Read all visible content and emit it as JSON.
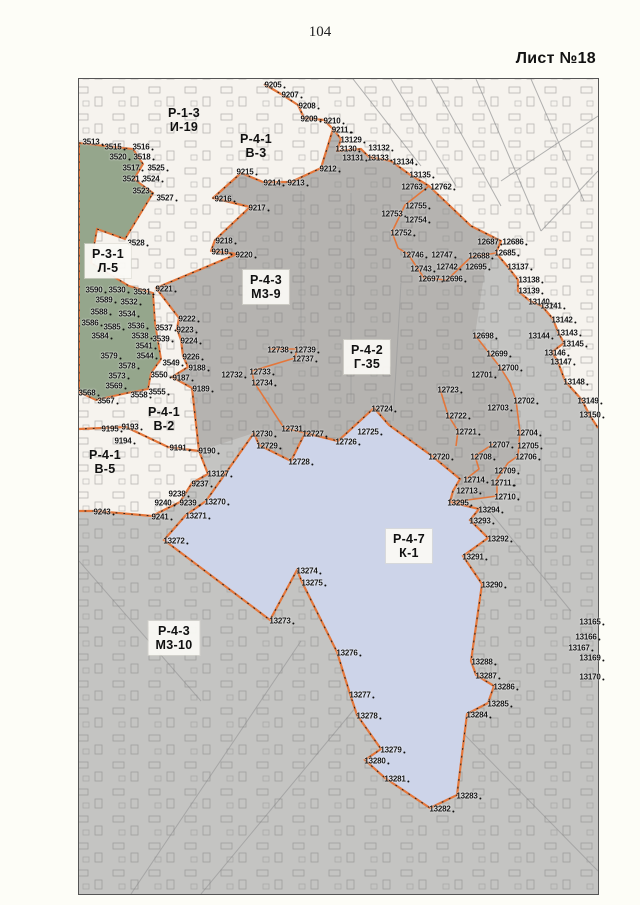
{
  "page": {
    "number": "104",
    "sheet_label": "Лист №18"
  },
  "map": {
    "colors": {
      "page_bg": "#fdfdf7",
      "map_white": "#f6f3ee",
      "gray_zone": "#c4c4c2",
      "dark_gray_zone": "#b5b3b0",
      "green_zone": "#95a68c",
      "lake": "#cdd4e9",
      "boundary_orange": "#e4763a"
    },
    "zones": [
      {
        "code": "Р-1-3",
        "sub": "И-19",
        "x": 183,
        "y": 119,
        "boxed": false
      },
      {
        "code": "Р-4-1",
        "sub": "В-3",
        "x": 255,
        "y": 145,
        "boxed": false
      },
      {
        "code": "Р-3-1",
        "sub": "Л-5",
        "x": 107,
        "y": 260,
        "boxed": true
      },
      {
        "code": "Р-4-3",
        "sub": "М3-9",
        "x": 265,
        "y": 286,
        "boxed": true
      },
      {
        "code": "Р-4-2",
        "sub": "Г-35",
        "x": 366,
        "y": 356,
        "boxed": true
      },
      {
        "code": "Р-4-1",
        "sub": "В-2",
        "x": 163,
        "y": 418,
        "boxed": false
      },
      {
        "code": "Р-4-1",
        "sub": "В-5",
        "x": 104,
        "y": 461,
        "boxed": false
      },
      {
        "code": "Р-4-7",
        "sub": "К-1",
        "x": 408,
        "y": 545,
        "boxed": true
      },
      {
        "code": "Р-4-3",
        "sub": "М3-10",
        "x": 173,
        "y": 637,
        "boxed": true
      }
    ],
    "points": [
      {
        "n": "3513",
        "x": 90,
        "y": 141
      },
      {
        "n": "3515",
        "x": 112,
        "y": 146
      },
      {
        "n": "3516",
        "x": 140,
        "y": 146
      },
      {
        "n": "3520",
        "x": 117,
        "y": 156
      },
      {
        "n": "3518",
        "x": 141,
        "y": 156
      },
      {
        "n": "3517",
        "x": 130,
        "y": 167
      },
      {
        "n": "3525",
        "x": 155,
        "y": 167
      },
      {
        "n": "3521",
        "x": 130,
        "y": 178
      },
      {
        "n": "3524",
        "x": 150,
        "y": 178
      },
      {
        "n": "3523",
        "x": 140,
        "y": 190
      },
      {
        "n": "3527",
        "x": 164,
        "y": 197
      },
      {
        "n": "3528",
        "x": 135,
        "y": 242
      },
      {
        "n": "9205",
        "x": 272,
        "y": 84
      },
      {
        "n": "9207",
        "x": 289,
        "y": 94
      },
      {
        "n": "9208",
        "x": 306,
        "y": 105
      },
      {
        "n": "9209",
        "x": 308,
        "y": 118
      },
      {
        "n": "9210",
        "x": 331,
        "y": 120
      },
      {
        "n": "9211",
        "x": 339,
        "y": 129
      },
      {
        "n": "13129",
        "x": 350,
        "y": 139
      },
      {
        "n": "13130",
        "x": 345,
        "y": 148
      },
      {
        "n": "13131",
        "x": 352,
        "y": 157
      },
      {
        "n": "13132",
        "x": 378,
        "y": 147
      },
      {
        "n": "13133",
        "x": 377,
        "y": 157
      },
      {
        "n": "13134",
        "x": 402,
        "y": 161
      },
      {
        "n": "13135",
        "x": 419,
        "y": 174
      },
      {
        "n": "9212",
        "x": 327,
        "y": 168
      },
      {
        "n": "9215",
        "x": 244,
        "y": 171
      },
      {
        "n": "9214",
        "x": 271,
        "y": 182
      },
      {
        "n": "9213",
        "x": 295,
        "y": 182
      },
      {
        "n": "9216",
        "x": 222,
        "y": 198
      },
      {
        "n": "9217",
        "x": 256,
        "y": 207
      },
      {
        "n": "9218",
        "x": 223,
        "y": 240
      },
      {
        "n": "9219",
        "x": 219,
        "y": 251
      },
      {
        "n": "9220",
        "x": 243,
        "y": 254
      },
      {
        "n": "12763",
        "x": 411,
        "y": 186
      },
      {
        "n": "12762",
        "x": 440,
        "y": 186
      },
      {
        "n": "12755",
        "x": 415,
        "y": 205
      },
      {
        "n": "12753",
        "x": 391,
        "y": 213
      },
      {
        "n": "12754",
        "x": 415,
        "y": 219
      },
      {
        "n": "12752",
        "x": 400,
        "y": 232
      },
      {
        "n": "12687",
        "x": 487,
        "y": 241
      },
      {
        "n": "12686",
        "x": 512,
        "y": 241
      },
      {
        "n": "12746",
        "x": 412,
        "y": 254
      },
      {
        "n": "12747",
        "x": 441,
        "y": 254
      },
      {
        "n": "12688",
        "x": 478,
        "y": 255
      },
      {
        "n": "12685",
        "x": 504,
        "y": 252
      },
      {
        "n": "12743",
        "x": 420,
        "y": 268
      },
      {
        "n": "12742",
        "x": 446,
        "y": 266
      },
      {
        "n": "12695",
        "x": 475,
        "y": 266
      },
      {
        "n": "13137",
        "x": 517,
        "y": 266
      },
      {
        "n": "12697",
        "x": 428,
        "y": 278
      },
      {
        "n": "12696",
        "x": 451,
        "y": 278
      },
      {
        "n": "13138",
        "x": 528,
        "y": 279
      },
      {
        "n": "13139",
        "x": 528,
        "y": 290
      },
      {
        "n": "13140",
        "x": 538,
        "y": 301
      },
      {
        "n": "9221",
        "x": 163,
        "y": 288
      },
      {
        "n": "3590",
        "x": 93,
        "y": 289
      },
      {
        "n": "3530",
        "x": 116,
        "y": 289
      },
      {
        "n": "3531",
        "x": 141,
        "y": 291
      },
      {
        "n": "3589",
        "x": 103,
        "y": 299
      },
      {
        "n": "3532",
        "x": 128,
        "y": 301
      },
      {
        "n": "3588",
        "x": 98,
        "y": 311
      },
      {
        "n": "3534",
        "x": 126,
        "y": 313
      },
      {
        "n": "3586",
        "x": 89,
        "y": 322
      },
      {
        "n": "3585",
        "x": 111,
        "y": 326
      },
      {
        "n": "3536",
        "x": 135,
        "y": 325
      },
      {
        "n": "3537",
        "x": 163,
        "y": 327
      },
      {
        "n": "3584",
        "x": 99,
        "y": 335
      },
      {
        "n": "3538",
        "x": 139,
        "y": 335
      },
      {
        "n": "3539",
        "x": 160,
        "y": 338
      },
      {
        "n": "3541",
        "x": 143,
        "y": 345
      },
      {
        "n": "3579",
        "x": 108,
        "y": 355
      },
      {
        "n": "3544",
        "x": 144,
        "y": 355
      },
      {
        "n": "3578",
        "x": 126,
        "y": 365
      },
      {
        "n": "3549",
        "x": 170,
        "y": 362
      },
      {
        "n": "3573",
        "x": 116,
        "y": 375
      },
      {
        "n": "3550",
        "x": 158,
        "y": 374
      },
      {
        "n": "3569",
        "x": 113,
        "y": 385
      },
      {
        "n": "3568",
        "x": 86,
        "y": 392
      },
      {
        "n": "3558",
        "x": 138,
        "y": 394
      },
      {
        "n": "3555",
        "x": 156,
        "y": 391
      },
      {
        "n": "3567",
        "x": 105,
        "y": 400
      },
      {
        "n": "9222",
        "x": 186,
        "y": 318
      },
      {
        "n": "9223",
        "x": 184,
        "y": 329
      },
      {
        "n": "9224",
        "x": 188,
        "y": 340
      },
      {
        "n": "9226",
        "x": 190,
        "y": 356
      },
      {
        "n": "9188",
        "x": 196,
        "y": 367
      },
      {
        "n": "9187",
        "x": 180,
        "y": 377
      },
      {
        "n": "9189",
        "x": 200,
        "y": 388
      },
      {
        "n": "13141",
        "x": 550,
        "y": 305
      },
      {
        "n": "13142",
        "x": 561,
        "y": 319
      },
      {
        "n": "13144",
        "x": 538,
        "y": 335
      },
      {
        "n": "13143",
        "x": 566,
        "y": 332
      },
      {
        "n": "13145",
        "x": 572,
        "y": 343
      },
      {
        "n": "13146",
        "x": 554,
        "y": 352
      },
      {
        "n": "13147",
        "x": 560,
        "y": 361
      },
      {
        "n": "13148",
        "x": 573,
        "y": 381
      },
      {
        "n": "13149",
        "x": 587,
        "y": 400
      },
      {
        "n": "13150",
        "x": 589,
        "y": 414
      },
      {
        "n": "12698",
        "x": 482,
        "y": 335
      },
      {
        "n": "12699",
        "x": 496,
        "y": 353
      },
      {
        "n": "12700",
        "x": 507,
        "y": 367
      },
      {
        "n": "12701",
        "x": 481,
        "y": 374
      },
      {
        "n": "12738",
        "x": 277,
        "y": 349
      },
      {
        "n": "12739",
        "x": 304,
        "y": 349
      },
      {
        "n": "12737",
        "x": 302,
        "y": 358
      },
      {
        "n": "12733",
        "x": 259,
        "y": 371
      },
      {
        "n": "12732",
        "x": 231,
        "y": 374
      },
      {
        "n": "12734",
        "x": 261,
        "y": 382
      },
      {
        "n": "12723",
        "x": 447,
        "y": 389
      },
      {
        "n": "12702",
        "x": 523,
        "y": 400
      },
      {
        "n": "12703",
        "x": 497,
        "y": 407
      },
      {
        "n": "12722",
        "x": 455,
        "y": 415
      },
      {
        "n": "12721",
        "x": 465,
        "y": 431
      },
      {
        "n": "12704",
        "x": 526,
        "y": 432
      },
      {
        "n": "12707",
        "x": 498,
        "y": 444
      },
      {
        "n": "12705",
        "x": 527,
        "y": 445
      },
      {
        "n": "12720",
        "x": 438,
        "y": 456
      },
      {
        "n": "12708",
        "x": 480,
        "y": 456
      },
      {
        "n": "12706",
        "x": 525,
        "y": 456
      },
      {
        "n": "12709",
        "x": 504,
        "y": 470
      },
      {
        "n": "12714",
        "x": 473,
        "y": 479
      },
      {
        "n": "12711",
        "x": 500,
        "y": 482
      },
      {
        "n": "12713",
        "x": 466,
        "y": 490
      },
      {
        "n": "12710",
        "x": 504,
        "y": 496
      },
      {
        "n": "12724",
        "x": 381,
        "y": 408
      },
      {
        "n": "12731",
        "x": 291,
        "y": 428
      },
      {
        "n": "12727",
        "x": 312,
        "y": 433
      },
      {
        "n": "12725",
        "x": 367,
        "y": 431
      },
      {
        "n": "12726",
        "x": 345,
        "y": 441
      },
      {
        "n": "12730",
        "x": 261,
        "y": 433
      },
      {
        "n": "12729",
        "x": 266,
        "y": 445
      },
      {
        "n": "12728",
        "x": 298,
        "y": 461
      },
      {
        "n": "9195",
        "x": 109,
        "y": 428
      },
      {
        "n": "9193",
        "x": 129,
        "y": 426
      },
      {
        "n": "9194",
        "x": 122,
        "y": 440
      },
      {
        "n": "9191",
        "x": 177,
        "y": 447
      },
      {
        "n": "9190",
        "x": 206,
        "y": 450
      },
      {
        "n": "13127",
        "x": 217,
        "y": 473
      },
      {
        "n": "9237",
        "x": 199,
        "y": 483
      },
      {
        "n": "9238",
        "x": 176,
        "y": 493
      },
      {
        "n": "9240",
        "x": 162,
        "y": 502
      },
      {
        "n": "9239",
        "x": 187,
        "y": 502
      },
      {
        "n": "13270",
        "x": 214,
        "y": 501
      },
      {
        "n": "9243",
        "x": 101,
        "y": 511
      },
      {
        "n": "9241",
        "x": 159,
        "y": 516
      },
      {
        "n": "13271",
        "x": 195,
        "y": 515
      },
      {
        "n": "13272",
        "x": 173,
        "y": 540
      },
      {
        "n": "13295",
        "x": 457,
        "y": 502
      },
      {
        "n": "13294",
        "x": 488,
        "y": 509
      },
      {
        "n": "13293",
        "x": 479,
        "y": 520
      },
      {
        "n": "13292",
        "x": 497,
        "y": 538
      },
      {
        "n": "13291",
        "x": 472,
        "y": 556
      },
      {
        "n": "13290",
        "x": 491,
        "y": 584
      },
      {
        "n": "13274",
        "x": 306,
        "y": 570
      },
      {
        "n": "13275",
        "x": 311,
        "y": 582
      },
      {
        "n": "13273",
        "x": 279,
        "y": 620
      },
      {
        "n": "13276",
        "x": 346,
        "y": 652
      },
      {
        "n": "13277",
        "x": 359,
        "y": 694
      },
      {
        "n": "13278",
        "x": 366,
        "y": 715
      },
      {
        "n": "13279",
        "x": 390,
        "y": 749
      },
      {
        "n": "13280",
        "x": 374,
        "y": 760
      },
      {
        "n": "13281",
        "x": 394,
        "y": 778
      },
      {
        "n": "13282",
        "x": 439,
        "y": 808
      },
      {
        "n": "13283",
        "x": 466,
        "y": 795
      },
      {
        "n": "13284",
        "x": 476,
        "y": 714
      },
      {
        "n": "13285",
        "x": 497,
        "y": 703
      },
      {
        "n": "13286",
        "x": 503,
        "y": 686
      },
      {
        "n": "13287",
        "x": 485,
        "y": 675
      },
      {
        "n": "13288",
        "x": 481,
        "y": 661
      },
      {
        "n": "13165",
        "x": 589,
        "y": 621
      },
      {
        "n": "13166",
        "x": 585,
        "y": 636
      },
      {
        "n": "13167",
        "x": 578,
        "y": 647
      },
      {
        "n": "13169",
        "x": 589,
        "y": 657
      },
      {
        "n": "13170",
        "x": 589,
        "y": 676
      }
    ]
  }
}
